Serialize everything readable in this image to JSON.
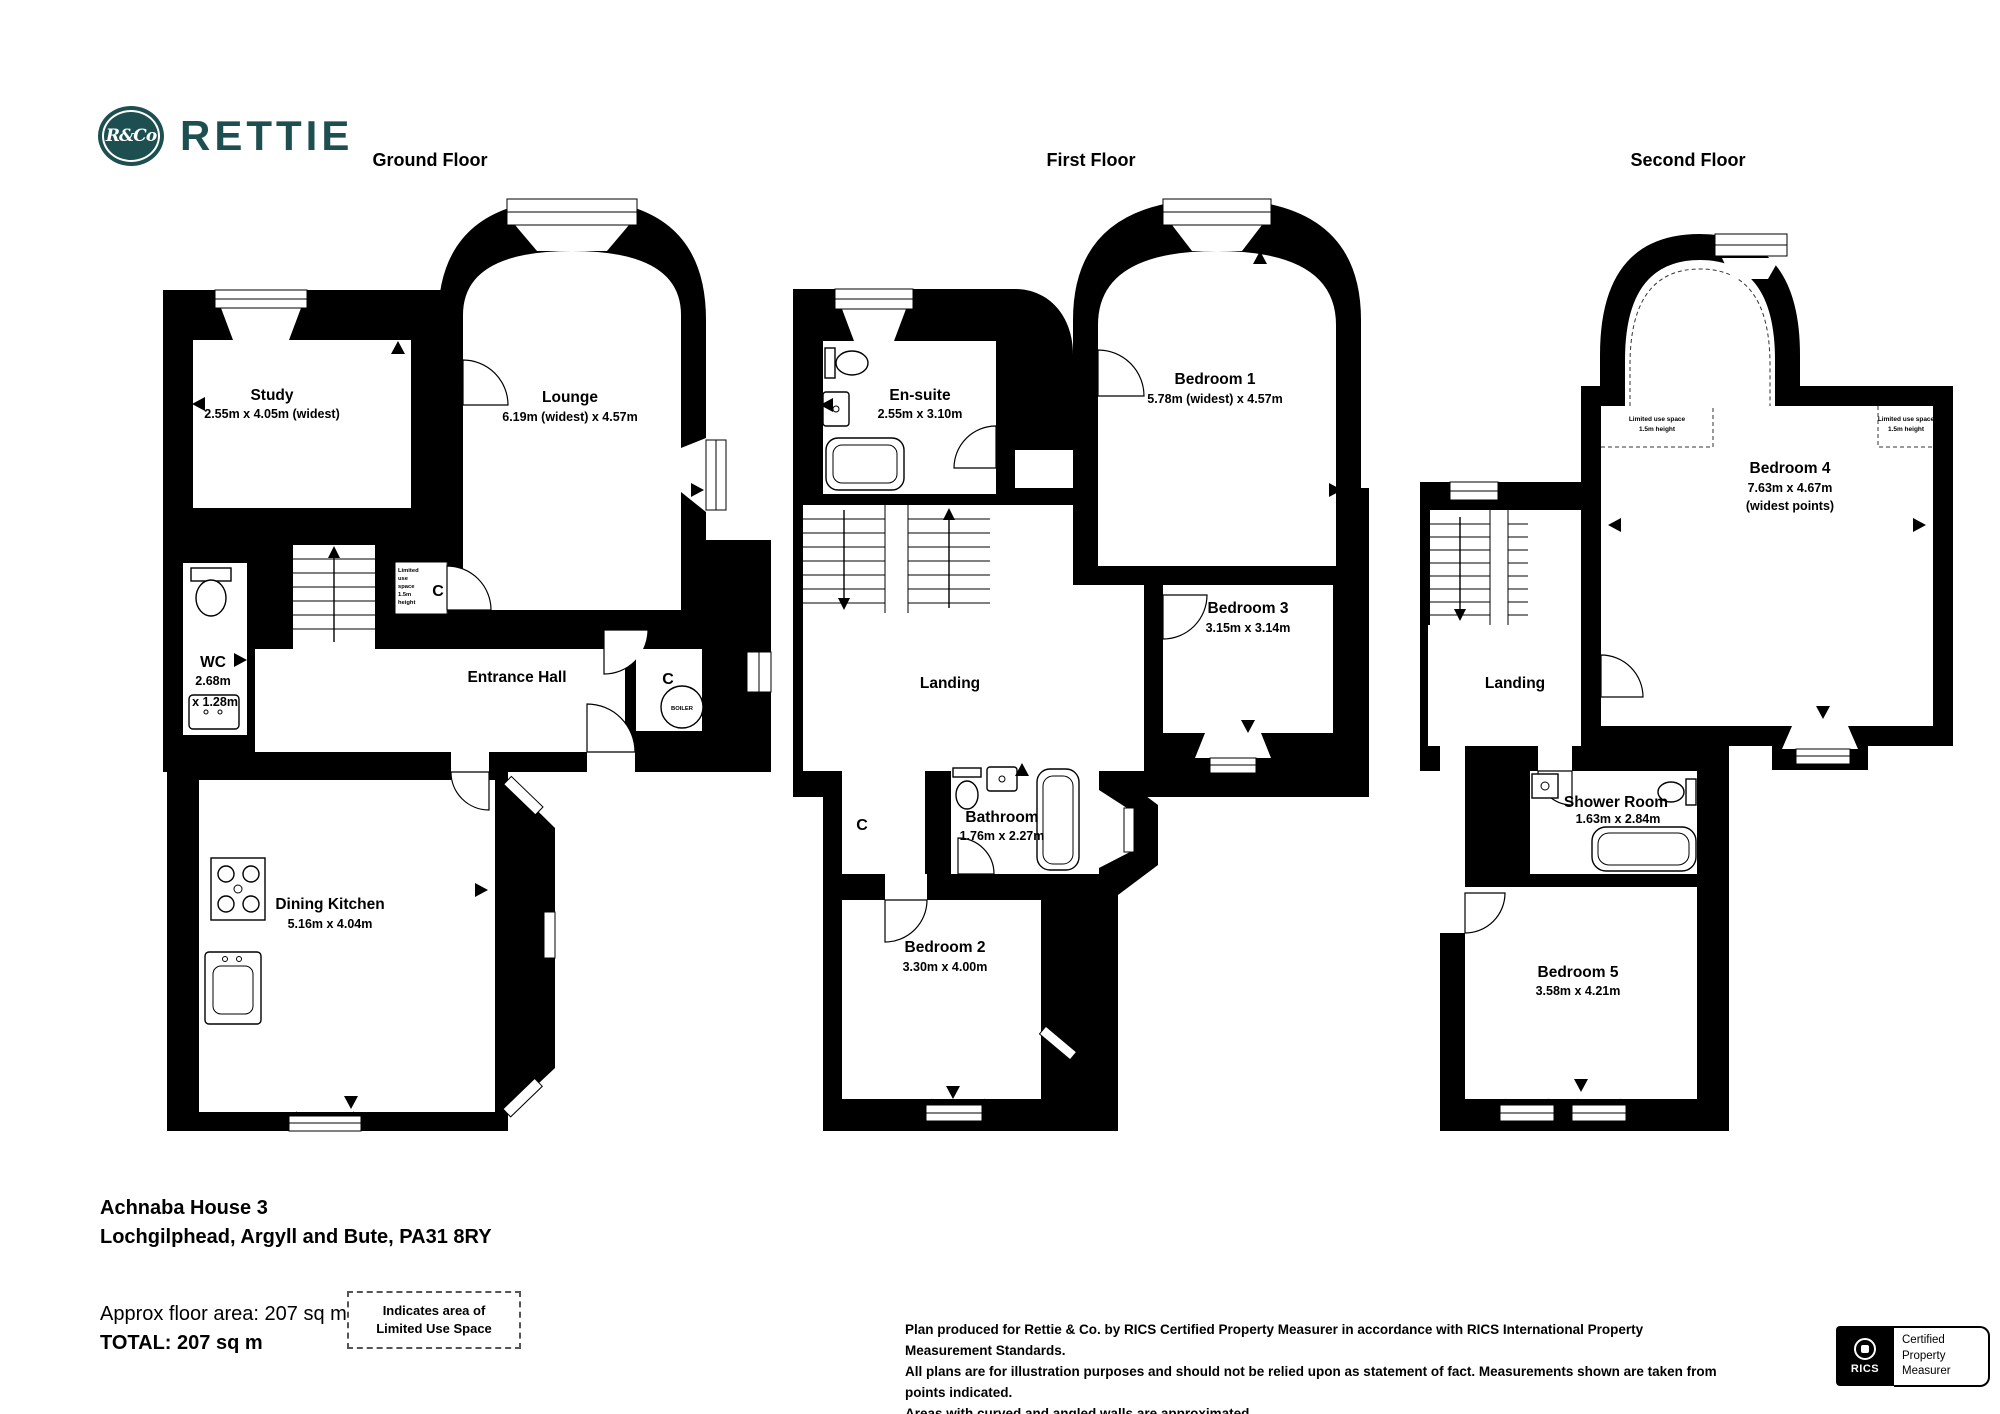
{
  "header": {
    "brand": {
      "monogram": "R&Co",
      "wordmark": "RETTIE",
      "color": "#1d4f50"
    }
  },
  "floors": [
    {
      "title": "Ground Floor",
      "rooms": {
        "study": {
          "name": "Study",
          "dims": "2.55m x 4.05m (widest)"
        },
        "lounge": {
          "name": "Lounge",
          "dims": "6.19m (widest) x 4.57m"
        },
        "wc": {
          "name": "WC",
          "dims_line1": "2.68m",
          "dims_line2": "x 1.28m"
        },
        "hall": {
          "name": "Entrance Hall"
        },
        "kitchen": {
          "name": "Dining Kitchen",
          "dims": "5.16m x 4.04m"
        }
      },
      "labels": {
        "up": "UP",
        "cupboard": "C",
        "boiler": "BOILER"
      },
      "limited": [
        "Limited",
        "use",
        "space",
        "1.5m",
        "height"
      ]
    },
    {
      "title": "First Floor",
      "rooms": {
        "ensuite": {
          "name": "En-suite",
          "dims": "2.55m x 3.10m"
        },
        "bed1": {
          "name": "Bedroom 1",
          "dims": "5.78m (widest) x 4.57m"
        },
        "bed3": {
          "name": "Bedroom 3",
          "dims": "3.15m x 3.14m"
        },
        "landing": {
          "name": "Landing"
        },
        "bathroom": {
          "name": "Bathroom",
          "dims": "1.76m x 2.27m"
        },
        "bed2": {
          "name": "Bedroom 2",
          "dims": "3.30m x 4.00m"
        }
      },
      "labels": {
        "down": "DOWN",
        "up": "UP",
        "cupboard": "C"
      }
    },
    {
      "title": "Second Floor",
      "rooms": {
        "bed4": {
          "name": "Bedroom 4",
          "dims": "7.63m x 4.67m",
          "note": "(widest points)"
        },
        "landing": {
          "name": "Landing"
        },
        "shower": {
          "name": "Shower Room",
          "dims": "1.63m x 2.84m"
        },
        "bed5": {
          "name": "Bedroom 5",
          "dims": "3.58m x 4.21m"
        }
      },
      "labels": {
        "down": "DOWN"
      },
      "limited_note": {
        "line1": "Limited use space",
        "line2": "1.5m height"
      }
    }
  ],
  "footer": {
    "address_line1": "Achnaba House 3",
    "address_line2": "Lochgilphead, Argyll and Bute, PA31 8RY",
    "area_line": "Approx floor area: 207 sq m",
    "total_line": "TOTAL: 207 sq m",
    "legend": {
      "line1": "Indicates area of",
      "line2": "Limited Use Space"
    },
    "disclaimer": {
      "line1": "Plan produced for Rettie & Co. by RICS Certified Property Measurer in accordance with RICS International Property Measurement Standards.",
      "line2": "All plans are for illustration purposes and should not be relied upon as statement of fact.  Measurements shown are taken from points indicated.",
      "line3": "Areas with curved and angled walls are approximated."
    },
    "rics": {
      "name": "RICS",
      "cert_line1": "Certified",
      "cert_line2": "Property",
      "cert_line3": "Measurer"
    }
  }
}
